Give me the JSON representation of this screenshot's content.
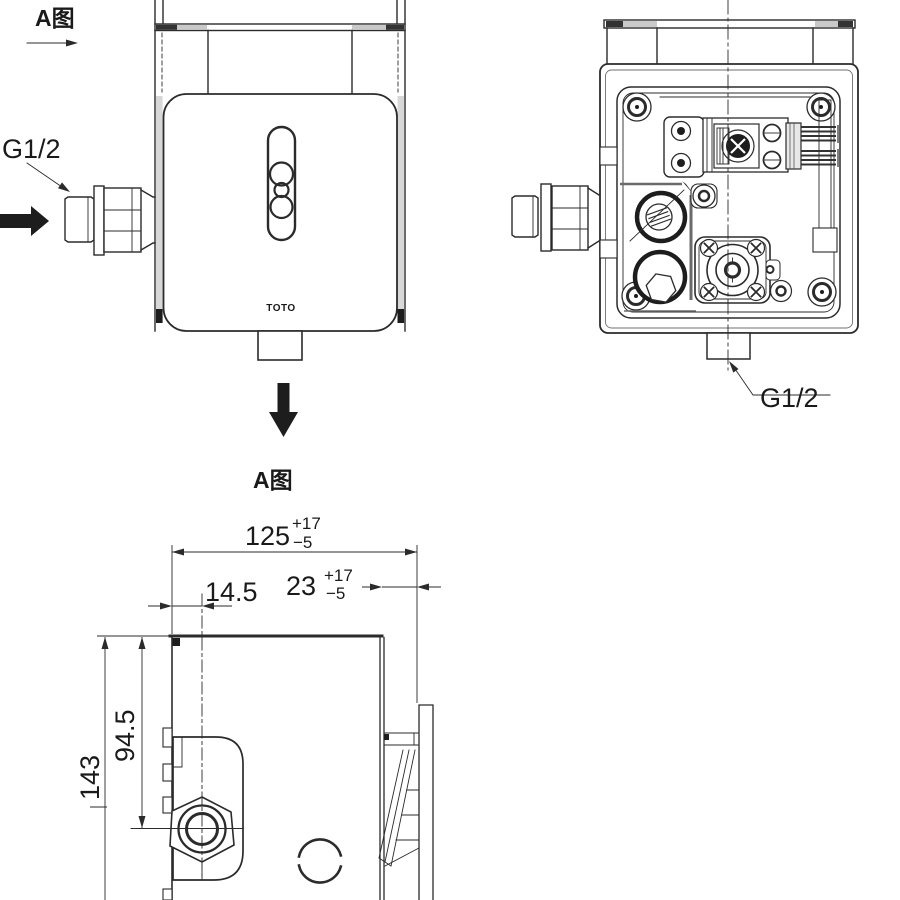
{
  "drawing": {
    "type": "technical-installation-drawing",
    "views": {
      "front_view": "concealed sensor flush valve - front elevation",
      "rear_view": "valve box internal mechanism - rear/open view",
      "detail_view": "view A - side section with mounting dimensions"
    }
  },
  "labels": {
    "view_marker_top": "A图",
    "view_title_bottom": "A图",
    "inlet_left": "G1/2",
    "outlet_right": "G1/2",
    "brand": "TOTO"
  },
  "dimensions": {
    "overall_width": {
      "nominal": "125",
      "upper": "+17",
      "lower": "−5"
    },
    "inlet_offset": {
      "nominal": "14.5"
    },
    "protrusion": {
      "nominal": "23",
      "upper": "+17",
      "lower": "−5"
    },
    "inlet_height": {
      "nominal": "94.5"
    },
    "overall_height": {
      "nominal": "143"
    }
  },
  "colors": {
    "line": "#2b2b2b",
    "dark_fill": "#333333",
    "gray_fill": "#c9c9c9",
    "background": "#ffffff"
  }
}
